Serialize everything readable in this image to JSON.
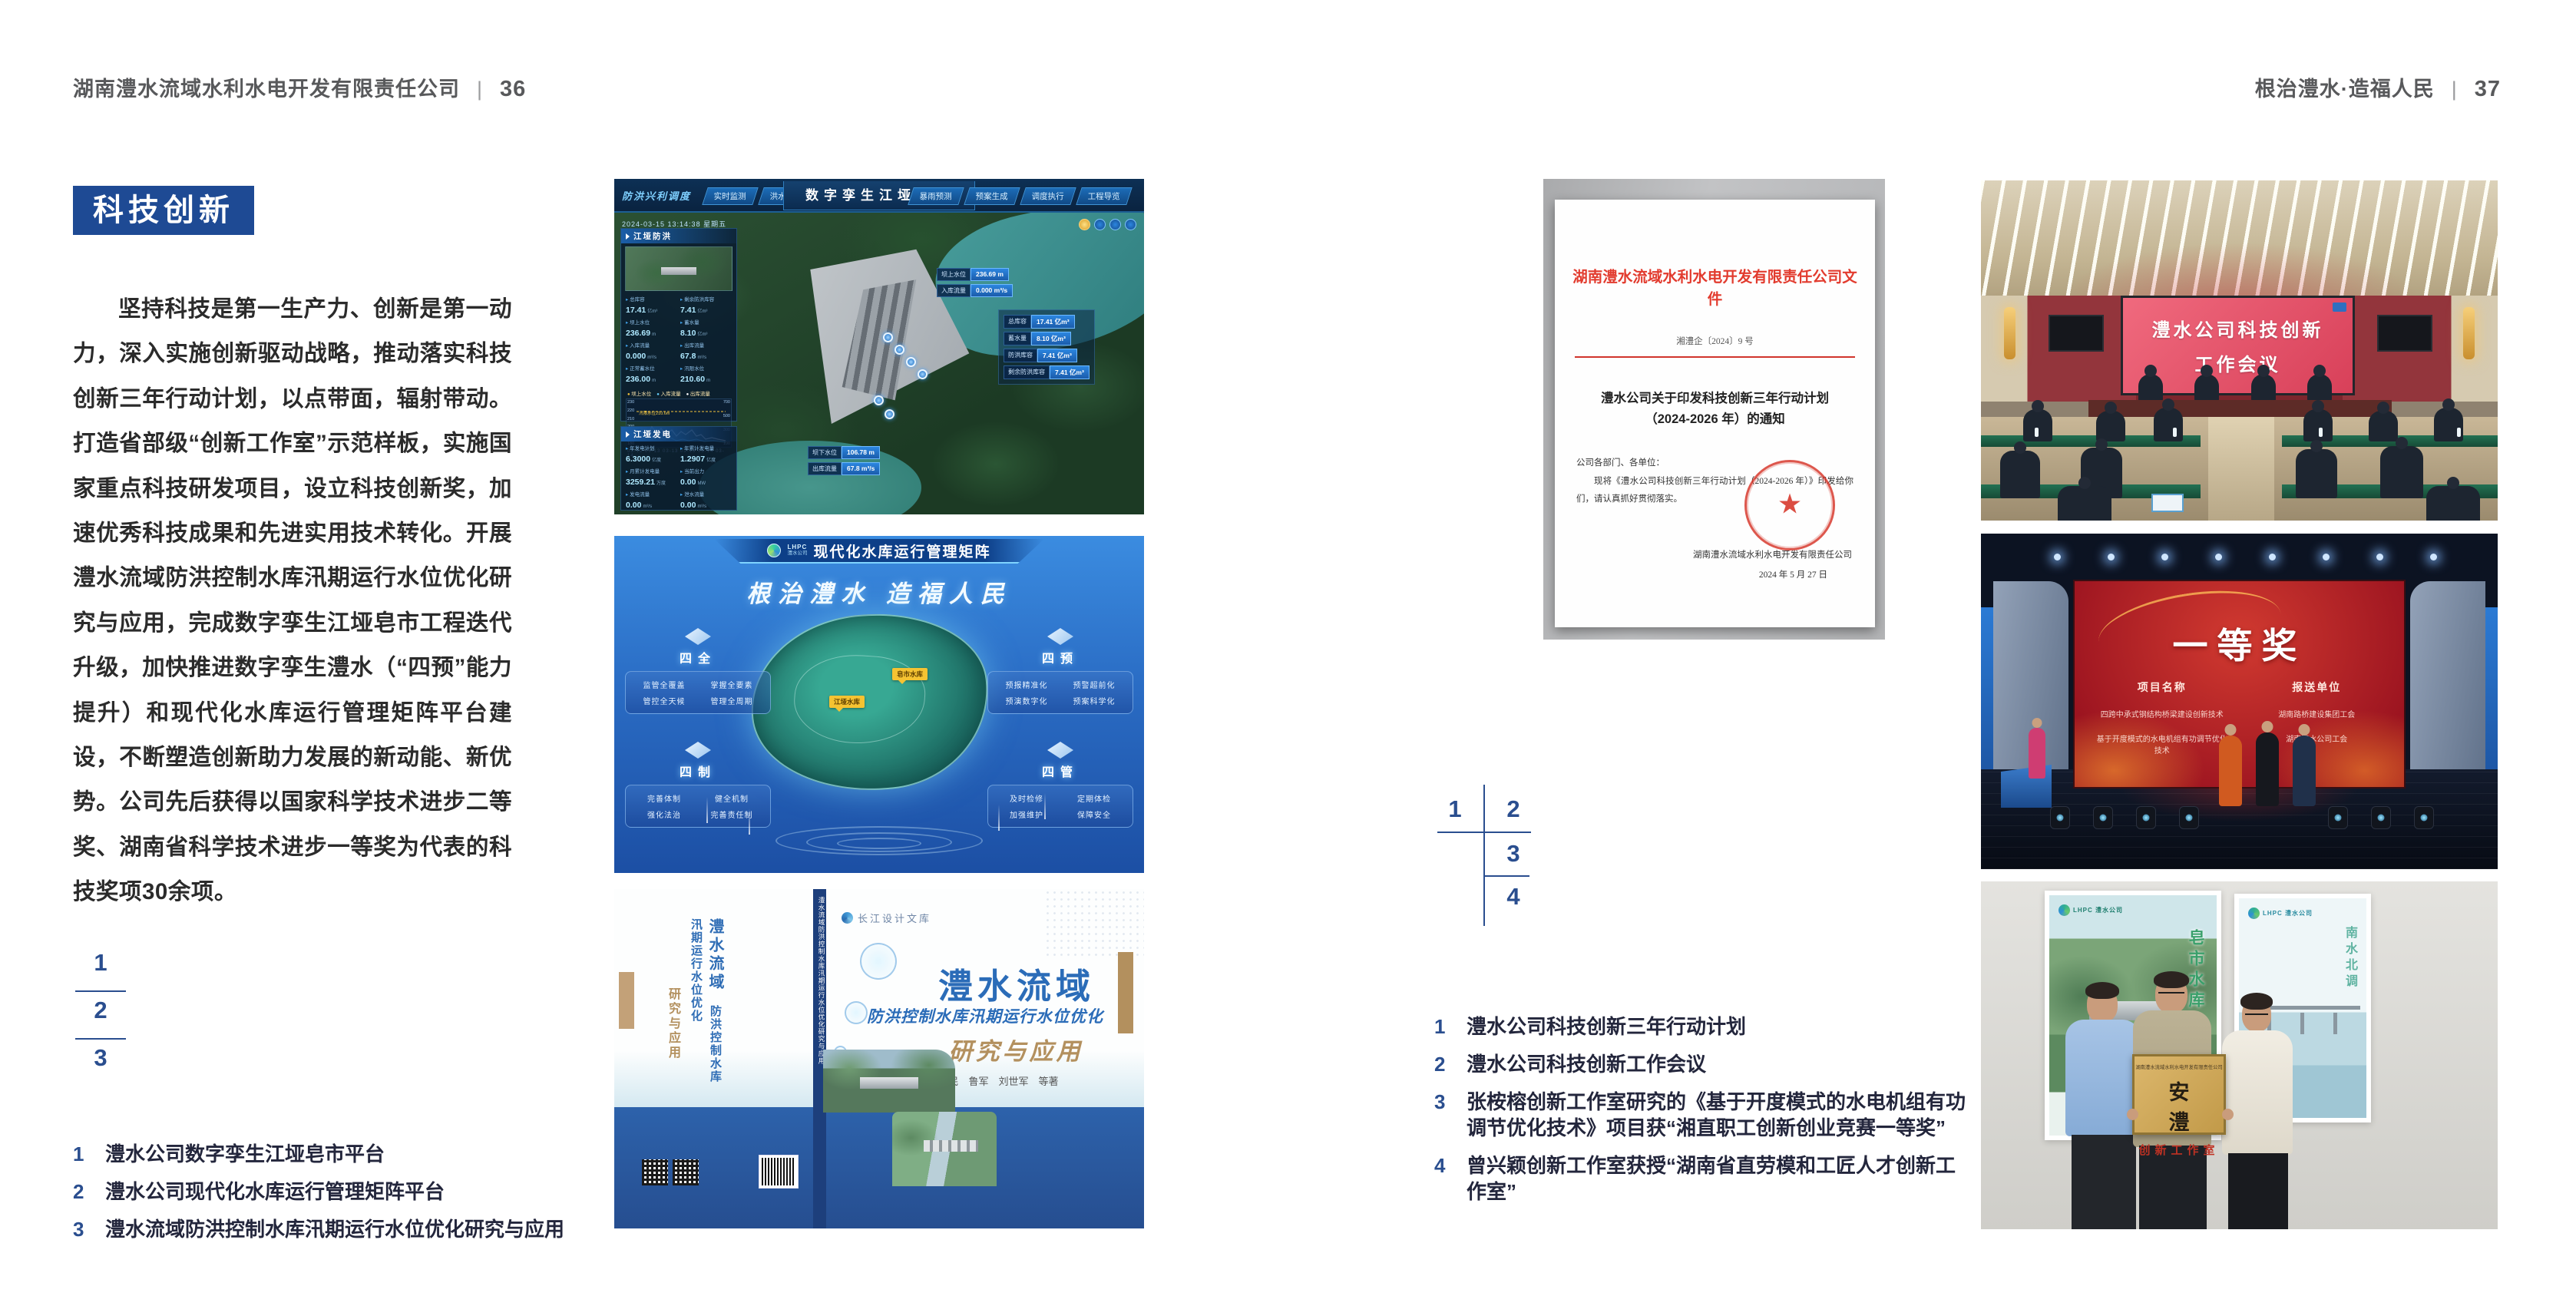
{
  "page": {
    "left_header": {
      "company": "湖南澧水流域水利水电开发有限责任公司",
      "divider": "|",
      "page_no": "36"
    },
    "right_header": {
      "motto": "根治澧水·造福人民",
      "divider": "|",
      "page_no": "37"
    }
  },
  "left_page": {
    "badge": "科技创新",
    "paragraph": "坚持科技是第一生产力、创新是第一动力，深入实施创新驱动战略，推动落实科技创新三年行动计划，以点带面，辐射带动。打造省部级“创新工作室”示范样板，实施国家重点科技研发项目，设立科技创新奖，加速优秀科技成果和先进实用技术转化。开展澧水流域防洪控制水库汛期运行水位优化研究与应用，完成数字孪生江垭皂市工程迭代升级，加快推进数字孪生澧水（“四预”能力提升）和现代化水库运行管理矩阵平台建设，不断塑造创新助力发展的新动能、新优势。公司先后获得以国家科学技术进步二等奖、湖南省科学技术进步一等奖为代表的科技奖项30余项。",
    "figure_numbers": [
      "1",
      "2",
      "3"
    ],
    "captions": [
      {
        "num": "1",
        "text": "澧水公司数字孪生江垭皂市平台"
      },
      {
        "num": "2",
        "text": "澧水公司现代化水库运行管理矩阵平台"
      },
      {
        "num": "3",
        "text": "澧水流域防洪控制水库汛期运行水位优化研究与应用"
      }
    ]
  },
  "right_page": {
    "figure_numbers": [
      "1",
      "2",
      "3",
      "4"
    ],
    "captions": [
      {
        "num": "1",
        "text": "澧水公司科技创新三年行动计划"
      },
      {
        "num": "2",
        "text": "澧水公司科技创新工作会议"
      },
      {
        "num": "3",
        "text": "张桉榕创新工作室研究的《基于开度模式的水电机组有功调节优化技术》项目获“湘直职工创新创业竞赛一等奖”"
      },
      {
        "num": "4",
        "text": "曾兴颖创新工作室获授“湖南省直劳模和工匠人才创新工作室”"
      }
    ]
  },
  "dashboard": {
    "nav_section": "防洪兴利调度",
    "tabs_left": [
      "实时监测",
      "洪水预报",
      "防洪预警"
    ],
    "title": "数字孪生江垭皂市",
    "tabs_right": [
      "暴雨预测",
      "预案生成",
      "调度执行",
      "工程导览"
    ],
    "datetime": "2024-03-15 13:14:38 星期五",
    "flood_panel": {
      "title": "江垭防洪",
      "stats": [
        {
          "label": "总库容",
          "value": "17.41",
          "unit": "亿m³"
        },
        {
          "label": "剩余防洪库容",
          "value": "7.41",
          "unit": "亿m³"
        },
        {
          "label": "坝上水位",
          "value": "236.69",
          "unit": "m"
        },
        {
          "label": "蓄水量",
          "value": "8.10",
          "unit": "亿m³"
        },
        {
          "label": "入库流量",
          "value": "0.000",
          "unit": "m³/s"
        },
        {
          "label": "出库流量",
          "value": "67.8",
          "unit": "m³/s"
        },
        {
          "label": "正常蓄水位",
          "value": "236.00",
          "unit": "m"
        },
        {
          "label": "汛限水位",
          "value": "210.60",
          "unit": "m"
        }
      ],
      "legend": [
        "坝上水位",
        "入库流量",
        "出库流量"
      ],
      "threshold_note": "汛限水位210.6m",
      "y_left": [
        "230",
        "220",
        "210",
        "200",
        "190",
        "180"
      ],
      "y_right": [
        "700",
        "500",
        "300",
        "100"
      ],
      "x_labels": "03-12  03-13  03-13  03-13  03-14  03-14"
    },
    "power_panel": {
      "title": "江垭发电",
      "stats": [
        {
          "label": "年发电计划",
          "value": "6.3000",
          "unit": "亿度"
        },
        {
          "label": "年累计发电量",
          "value": "1.2907",
          "unit": "亿度"
        },
        {
          "label": "月累计发电量",
          "value": "3259.21",
          "unit": "万度"
        },
        {
          "label": "当前出力",
          "value": "0.00",
          "unit": "MW"
        },
        {
          "label": "发电流量",
          "value": "0.00",
          "unit": "m³/s"
        },
        {
          "label": "泄水流量",
          "value": "0.00",
          "unit": "m³/s"
        }
      ]
    },
    "callout_top": [
      {
        "label": "坝上水位",
        "value": "236.69 m"
      },
      {
        "label": "入库流量",
        "value": "0.000 m³/s"
      }
    ],
    "callout_panel": [
      {
        "label": "总库容",
        "value": "17.41 亿m³"
      },
      {
        "label": "蓄水量",
        "value": "8.10 亿m³"
      },
      {
        "label": "防洪库容",
        "value": "7.41 亿m³"
      },
      {
        "label": "剩余防洪库容",
        "value": "7.41 亿m³"
      }
    ],
    "callout_bottom": [
      {
        "label": "坝下水位",
        "value": "106.78 m"
      },
      {
        "label": "出库流量",
        "value": "67.8 m³/s"
      }
    ]
  },
  "matrix": {
    "logo": "LHPC",
    "logo_sub": "澧水公司",
    "title": "现代化水库运行管理矩阵",
    "slogan": "根治澧水 造福人民",
    "quadrants": [
      {
        "name": "四全",
        "items": [
          "监管全覆盖",
          "掌握全要素",
          "管控全天候",
          "管理全周期"
        ]
      },
      {
        "name": "四预",
        "items": [
          "预报精准化",
          "预警超前化",
          "预演数字化",
          "预案科学化"
        ]
      },
      {
        "name": "四制",
        "items": [
          "完善体制",
          "健全机制",
          "强化法治",
          "完善责任制"
        ]
      },
      {
        "name": "四管",
        "items": [
          "及时检修",
          "定期体检",
          "加强维护",
          "保障安全"
        ]
      }
    ],
    "map_tags": [
      "江垭水库",
      "皂市水库"
    ]
  },
  "book": {
    "publisher": "长江设计文库",
    "title": "澧水流域",
    "subtitle": "防洪控制水库汛期运行水位优化",
    "subtitle2": "研究与应用",
    "authors": "洪兴骏　沈坤民　鲁军　刘世军　等著",
    "spine_title": "澧水流域防洪控制水库汛期运行水位优化研究与应用"
  },
  "document": {
    "header": "湖南澧水流域水利水电开发有限责任公司文件",
    "doc_no": "湘澧企〔2024〕9 号",
    "title_line1": "澧水公司关于印发科技创新三年行动计划",
    "title_line2": "（2024-2026 年）的通知",
    "salutation": "公司各部门、各单位：",
    "body": "现将《澧水公司科技创新三年行动计划（2024-2026 年）》印发给你们，请认真抓好贯彻落实。",
    "signature": "湖南澧水流域水利水电开发有限责任公司",
    "date": "2024 年 5 月 27 日"
  },
  "meeting": {
    "screen_line1": "澧水公司科技创新",
    "screen_line2": "工作会议"
  },
  "award": {
    "title": "一等奖",
    "col1_header": "项目名称",
    "col1_items": [
      "四跨中承式钢结构桥梁建设创新技术",
      "基于开度模式的水电机组有功调节优化技术"
    ],
    "col2_header": "报送单位",
    "col2_items": [
      "湖南路桥建设集团工会",
      "湖南澧水公司工会"
    ]
  },
  "plaque": {
    "org": "湖南澧水流域水利水电开发有限责任公司",
    "name": "安　澧",
    "type": "创新工作室",
    "poster_left_logo": "LHPC 澧水公司",
    "poster_left_text": "皂市水库",
    "poster_right_logo": "LHPC 澧水公司",
    "poster_right_text": "南水北调"
  },
  "colors": {
    "badge_blue": "#1e4a94",
    "figure_number_blue": "#2a4e8f",
    "header_gray": "#58595b",
    "document_red": "#d9382c",
    "book_blue": "#2b6cb8",
    "book_gold": "#b3905e"
  }
}
